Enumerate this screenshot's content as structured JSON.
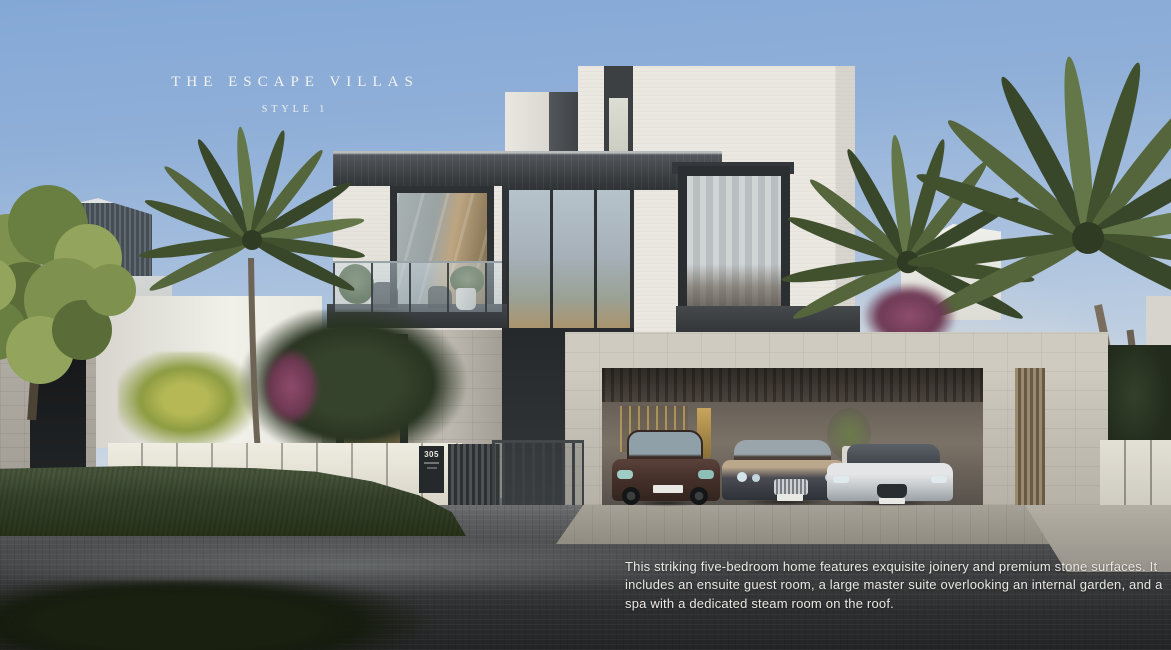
{
  "overlay": {
    "title": "THE ESCAPE VILLAS",
    "subtitle": "STYLE 1",
    "description": "This striking five-bedroom home features exquisite joinery and premium stone surfaces. It includes an ensuite guest room, a large master suite overlooking an internal garden, and a spa with a dedicated steam room on the roof."
  },
  "villa": {
    "address_plaque": "305",
    "garage_cars": [
      "maroon coupe",
      "dark blue grand tourer",
      "white sports car"
    ]
  },
  "colors": {
    "sky_top": "#84a8d6",
    "sky_horizon": "#e6e5e0",
    "villa_white": "#ebe8e2",
    "frame_charcoal": "#33373a",
    "stone": "#c3bfb5",
    "wood_door": "#c5a271",
    "hedge_green": "#35422b",
    "palm_green": "#55663c",
    "bougainvillea": "#8e4d6d",
    "road_dark": "#2c2d2e",
    "text_white": "#f4f2ee"
  }
}
